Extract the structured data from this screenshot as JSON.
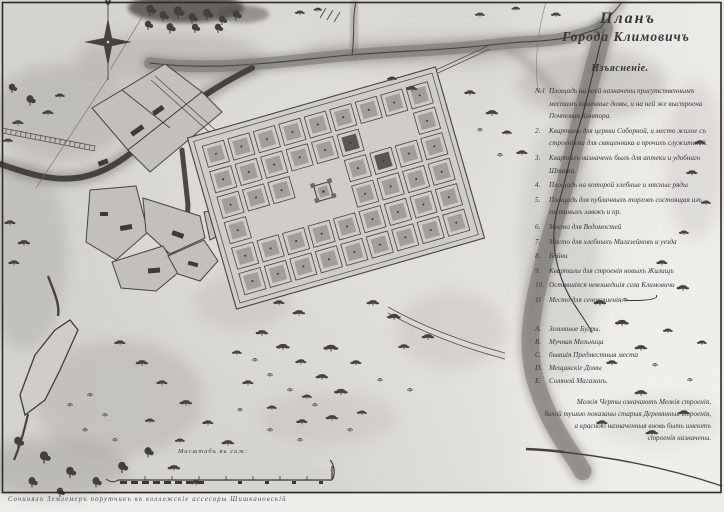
{
  "title": {
    "line1": "Планъ",
    "line2": "Города Климовичъ"
  },
  "legend": {
    "header": "Изъясненіе.",
    "items": [
      {
        "num": "№1",
        "text": "Площадь на коей назначены присутственнымъ местамъ каменные домы, и на ней же выстроена Почтовая Контора."
      },
      {
        "num": "2.",
        "text": "Кварталы для церкви Соборной, и место жилое съ строеніями для священника и прочихъ служителей."
      },
      {
        "num": "3.",
        "text": "Кварталъ назначенъ былъ для аптеки и удобнаго Штата."
      },
      {
        "num": "4.",
        "text": "Площадь на которой хлебные и мясные ряды"
      },
      {
        "num": "5.",
        "text": "Площадь для публичныхъ торговъ состоящая изъ гостиныхъ лавокъ и пр."
      },
      {
        "num": "6.",
        "text": "Место для Ведомостей"
      },
      {
        "num": "7.",
        "text": "Место для хлебныхъ Магазейновъ и уезда"
      },
      {
        "num": "8.",
        "text": "Бойни"
      },
      {
        "num": "9.",
        "text": "Кварталы для строенія новыхъ Жилищъ"
      },
      {
        "num": "10.",
        "text": "Оставшіяся невошедшія села Климовичи"
      },
      {
        "num": "11",
        "text": "Место для сенокошенія."
      }
    ],
    "letter_items": [
      {
        "num": "А.",
        "text": "Земляные Бугры."
      },
      {
        "num": "В.",
        "text": "Мучная Мельница"
      },
      {
        "num": "С.",
        "text": "бывшія Предместныя места"
      },
      {
        "num": "D.",
        "text": "Мещанскіе Домы"
      },
      {
        "num": "Е.",
        "text": "Соляной Магазинъ."
      }
    ],
    "note_lines": [
      "Мелкія Черты означаютъ Мелкія строенія,",
      "белой тушью показаны старыя Деревянныя строенія,",
      "а красною назначенныя вновь быть имеютъ",
      "строенія назначены."
    ]
  },
  "scale": {
    "label": "Масштабъ въ саж:"
  },
  "caption": "Сочинялъ Землемеръ порутчикъ въ коллежскіе ассесоры Шишкановскій",
  "icons": {
    "compass": "compass-rose"
  },
  "colors": {
    "paper": "#d6d4d0",
    "paper_light": "#eceae6",
    "ink": "#37363c",
    "map_ink": "#3d3a37",
    "wash": "#8d8a86",
    "block_fill": "#cfccc8",
    "block_inner": "#a29e9a",
    "river": "#46423e"
  }
}
